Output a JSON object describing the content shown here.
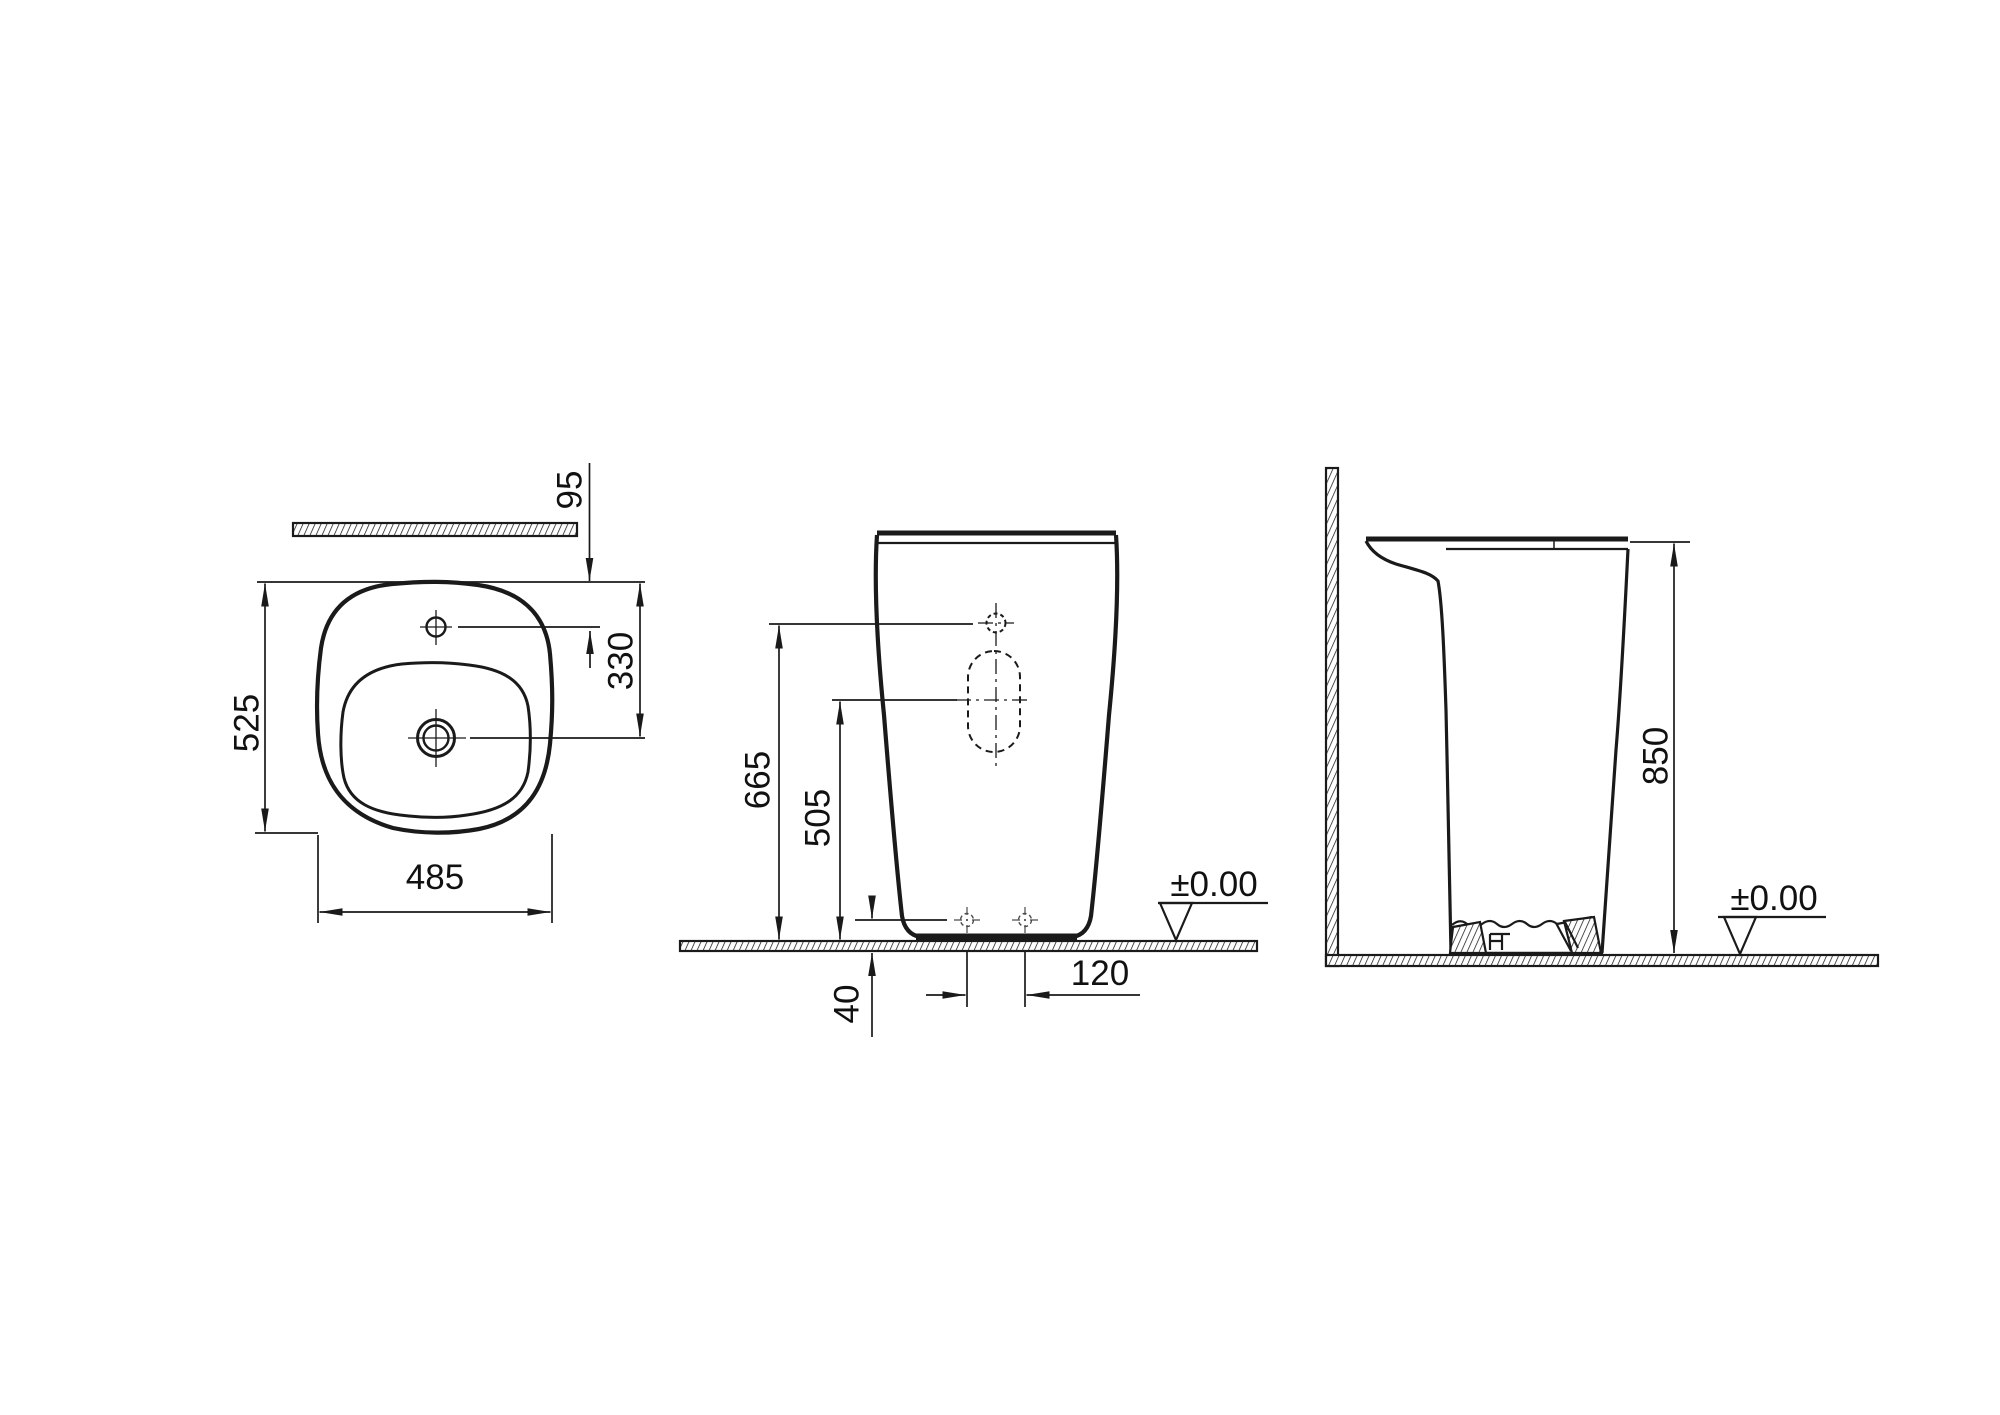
{
  "colors": {
    "line": "#1a1a1a",
    "background": "#ffffff"
  },
  "top_view": {
    "overall_depth": "525",
    "overall_width": "485",
    "wall_clearance": "95",
    "rim_to_drain_center": "330"
  },
  "front_view": {
    "tap_hole_height": "665",
    "drain_center_height": "505",
    "base_recess_height": "40",
    "fixing_hole_spacing": "120",
    "floor_level": "±0.00"
  },
  "side_view": {
    "overall_height": "850",
    "floor_level": "±0.00"
  }
}
